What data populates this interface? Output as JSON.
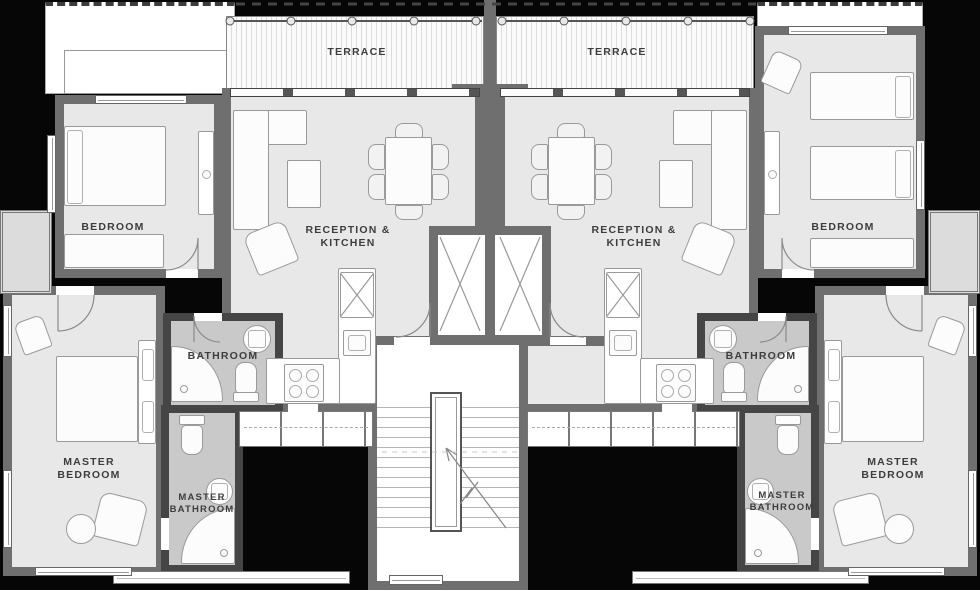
{
  "palette": {
    "background": "#060606",
    "wall": "#6f6f6f",
    "bathroom_wall": "#454545",
    "floor": "#e8e8e8",
    "bathroom_floor": "#c9c9c9",
    "terrace_stripe": "#dcdcdc",
    "label_text": "#3d3d3d"
  },
  "units": {
    "left": {
      "terrace_label": "TERRACE",
      "bedroom_label": "BEDROOM",
      "reception_label_line1": "RECEPTION &",
      "reception_label_line2": "KITCHEN",
      "bathroom_label": "BATHROOM",
      "master_bedroom_label_line1": "MASTER",
      "master_bedroom_label_line2": "BEDROOM",
      "master_bathroom_label_line1": "MASTER",
      "master_bathroom_label_line2": "BATHROOM"
    },
    "right": {
      "terrace_label": "TERRACE",
      "bedroom_label": "BEDROOM",
      "reception_label_line1": "RECEPTION &",
      "reception_label_line2": "KITCHEN",
      "bathroom_label": "BATHROOM",
      "master_bedroom_label_line1": "MASTER",
      "master_bedroom_label_line2": "BEDROOM",
      "master_bathroom_label_line1": "MASTER",
      "master_bathroom_label_line2": "BATHROOM"
    }
  }
}
